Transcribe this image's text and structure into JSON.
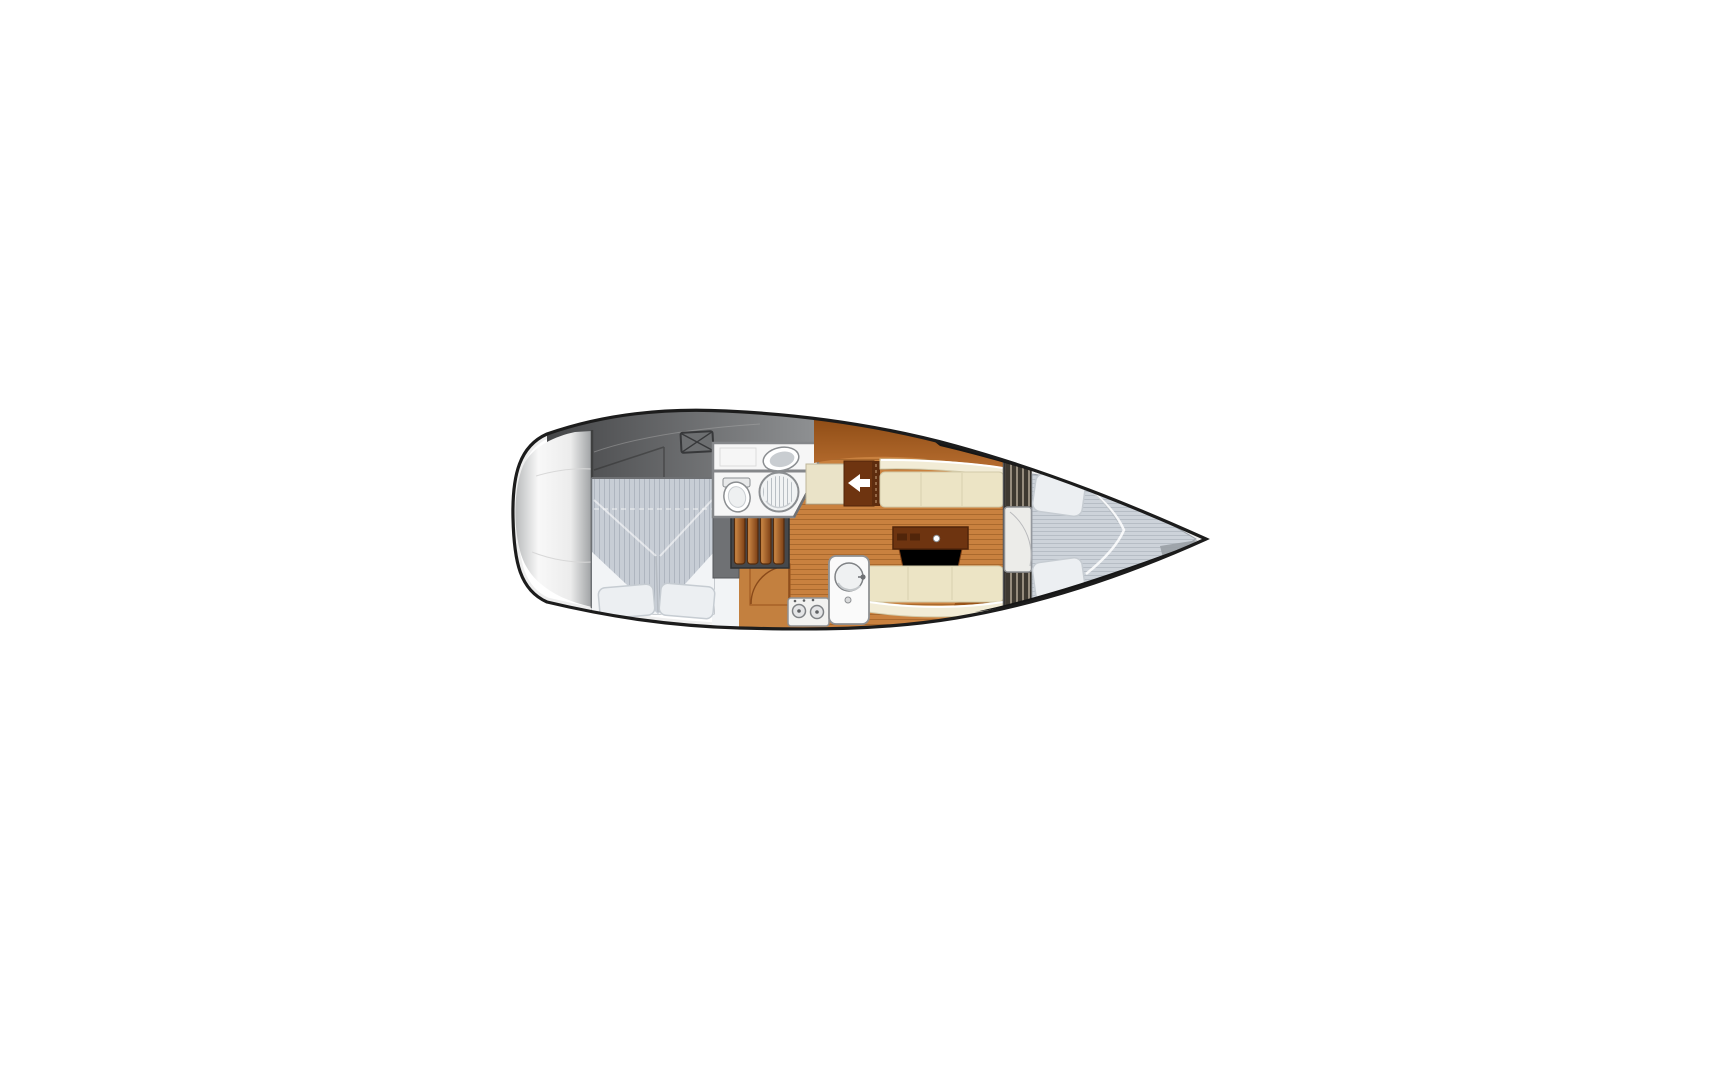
{
  "figure": {
    "type": "floor-plan",
    "subject": "sailing-yacht-interior-layout",
    "orientation": "bow-right"
  },
  "areas": [
    {
      "id": "stern-platform",
      "label": "stern swim platform"
    },
    {
      "id": "cockpit-deck",
      "label": "aft cockpit deck"
    },
    {
      "id": "deck-hatch",
      "label": "deck hatch with X cross"
    },
    {
      "id": "aft-cabin",
      "label": "aft double berth cabin with two pillows"
    },
    {
      "id": "head-compartment",
      "label": "head with vanity sink, toilet and shower"
    },
    {
      "id": "companionway-steps",
      "label": "companionway steps"
    },
    {
      "id": "galley",
      "label": "galley with two-burner stove and round sink"
    },
    {
      "id": "salon-floor",
      "label": "salon wood plank sole"
    },
    {
      "id": "starboard-settee",
      "label": "starboard settee"
    },
    {
      "id": "port-settee",
      "label": "port settee"
    },
    {
      "id": "salon-table",
      "label": "salon table"
    },
    {
      "id": "companionway-panel",
      "label": "panel with arrow pointing aft (left)"
    },
    {
      "id": "forward-bulkhead",
      "label": "forward bulkhead with slatted lockers and cabin door"
    },
    {
      "id": "v-berth",
      "label": "forward V-berth with two pillows"
    },
    {
      "id": "bow-deck",
      "label": "bow deck wedge"
    }
  ],
  "palette": {
    "background": "#ffffff",
    "hullLine": "#1c1c1c",
    "bowBand": "#161616",
    "innerShade": "#cfcfcf",
    "topShade": "#bfc1c2",
    "capEdge": "#b9bbbc",
    "capLight": "#f8f8f8",
    "capMid": "#ececec",
    "capDark": "#9da0a2",
    "capSeam": "#d8d8d8",
    "capDivider": "#3f4040",
    "deckDark": "#454648",
    "deckLight": "#8e9092",
    "deckLine": "#2e2e2e",
    "deckHighlight": "#a6a6a6",
    "hatchFill": "#6d6f71",
    "hatchLine": "#37383a",
    "floorBase": "#c9813f",
    "floorLine": "#9a5c24",
    "counter": "#c3803f",
    "counterLine": "#a05a22",
    "counterDoor": "#8a4a1a",
    "headFloor": "#f6f6f6",
    "headWall": "#85878a",
    "white": "#ffffff",
    "fixtureStroke": "#8b8e91",
    "sinkInner": "#c9cdd1",
    "toiletInner": "#eef0f1",
    "tankFill": "#e8e9ea",
    "showerBase": "#f1f3f4",
    "showerLine": "#b9bfc4",
    "wallMid": "#6f7174",
    "wallEdge": "#54565a",
    "stepWell": "#46484b",
    "stepWellEdge": "#2f3032",
    "stepSlatLight": "#d08c48",
    "stepSlatDark": "#7c3f15",
    "stepSlatEdge": "#542c0d",
    "bandTop": "#8f4d16",
    "bandBottom": "#b76d2f",
    "creamPanel": "#eae3c8",
    "creamPanelEdge": "#bdb59a",
    "panelBrown": "#6e3410",
    "panelBrownEdge": "#51250a",
    "hingeStrip": "#5e2c0e",
    "hingeDash": "#caa27c",
    "arrowWhite": "#ffffff",
    "seatCream": "#ece4c5",
    "seatCreamLight": "#f2ecd6",
    "seatEdge": "#d2caa9",
    "seatSeam": "#d8d0b0",
    "piping": "#ffffff",
    "bulkhead": "#515356",
    "lockerBase": "#3e3931",
    "lockerSlat": "#968c7d",
    "lockerEdge": "#2e2b26",
    "doorFill": "#ecece9",
    "doorEdge": "#8f9194",
    "doorArc": "#b9babc",
    "mattressBase": "#c7cdd5",
    "mattressStripe": "#aeb5bf",
    "mattressEdge": "#9aa0a8",
    "foldWhite": "#ffffff",
    "crease": "#aab0b8",
    "bedding": "#f2f4f6",
    "pillow": "#eceff2",
    "pillowEdge": "#c6ccd2",
    "bowMattressBase": "#cdd3da",
    "bowMattressStripe": "#b6bdc5",
    "anchorGrey": "#9aa0a5",
    "sliverOrange": "#9a5418",
    "stoveFill": "#f2f2f0",
    "burner": "#e4e5e6",
    "burnerEdge": "#7f8285",
    "dotDark": "#5f6163",
    "sinkUnitFill": "#fafafa",
    "sinkBowl": "#eff1f2",
    "faucet": "#6f7174",
    "sinkShade": "#c3c7ca",
    "knobGrey": "#d9dadb"
  }
}
